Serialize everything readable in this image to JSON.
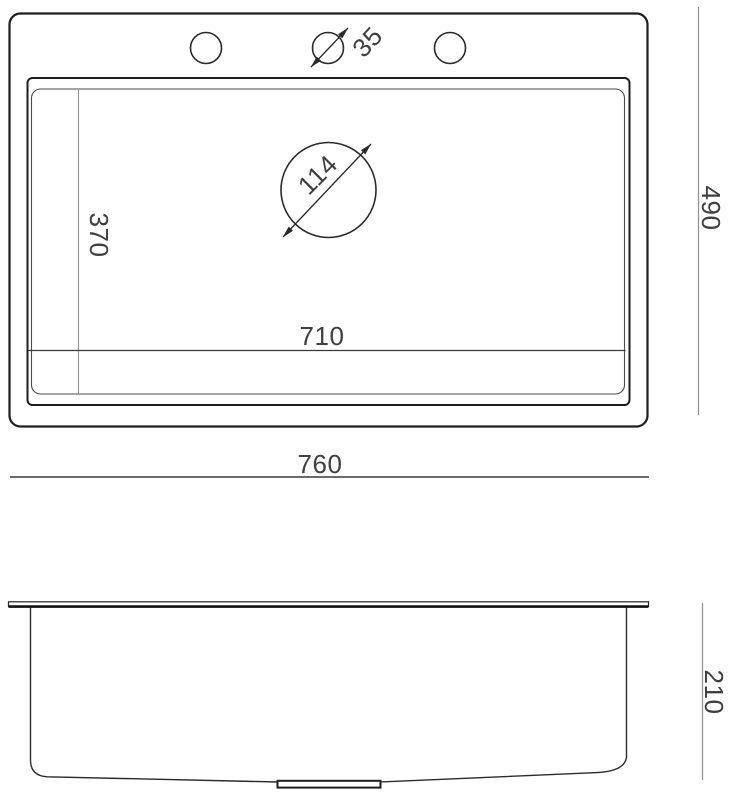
{
  "drawing": {
    "type": "technical-dimension-drawing",
    "views": [
      "top-view",
      "side-profile-view"
    ],
    "colors": {
      "background": "#ffffff",
      "outline": "#1d1d1d",
      "thin_line": "#4a4a4a",
      "dim_line_light": "#8f8f8f",
      "dim_line_dark": "#3a3a3a",
      "text": "#3f3f3f"
    },
    "top_view": {
      "labels": {
        "faucet_hole_diameter": "35",
        "drain_diameter": "114",
        "bowl_depth": "370",
        "bowl_width": "710",
        "overall_width": "760",
        "overall_depth": "490"
      }
    },
    "side_view": {
      "labels": {
        "overall_height": "210"
      }
    }
  }
}
